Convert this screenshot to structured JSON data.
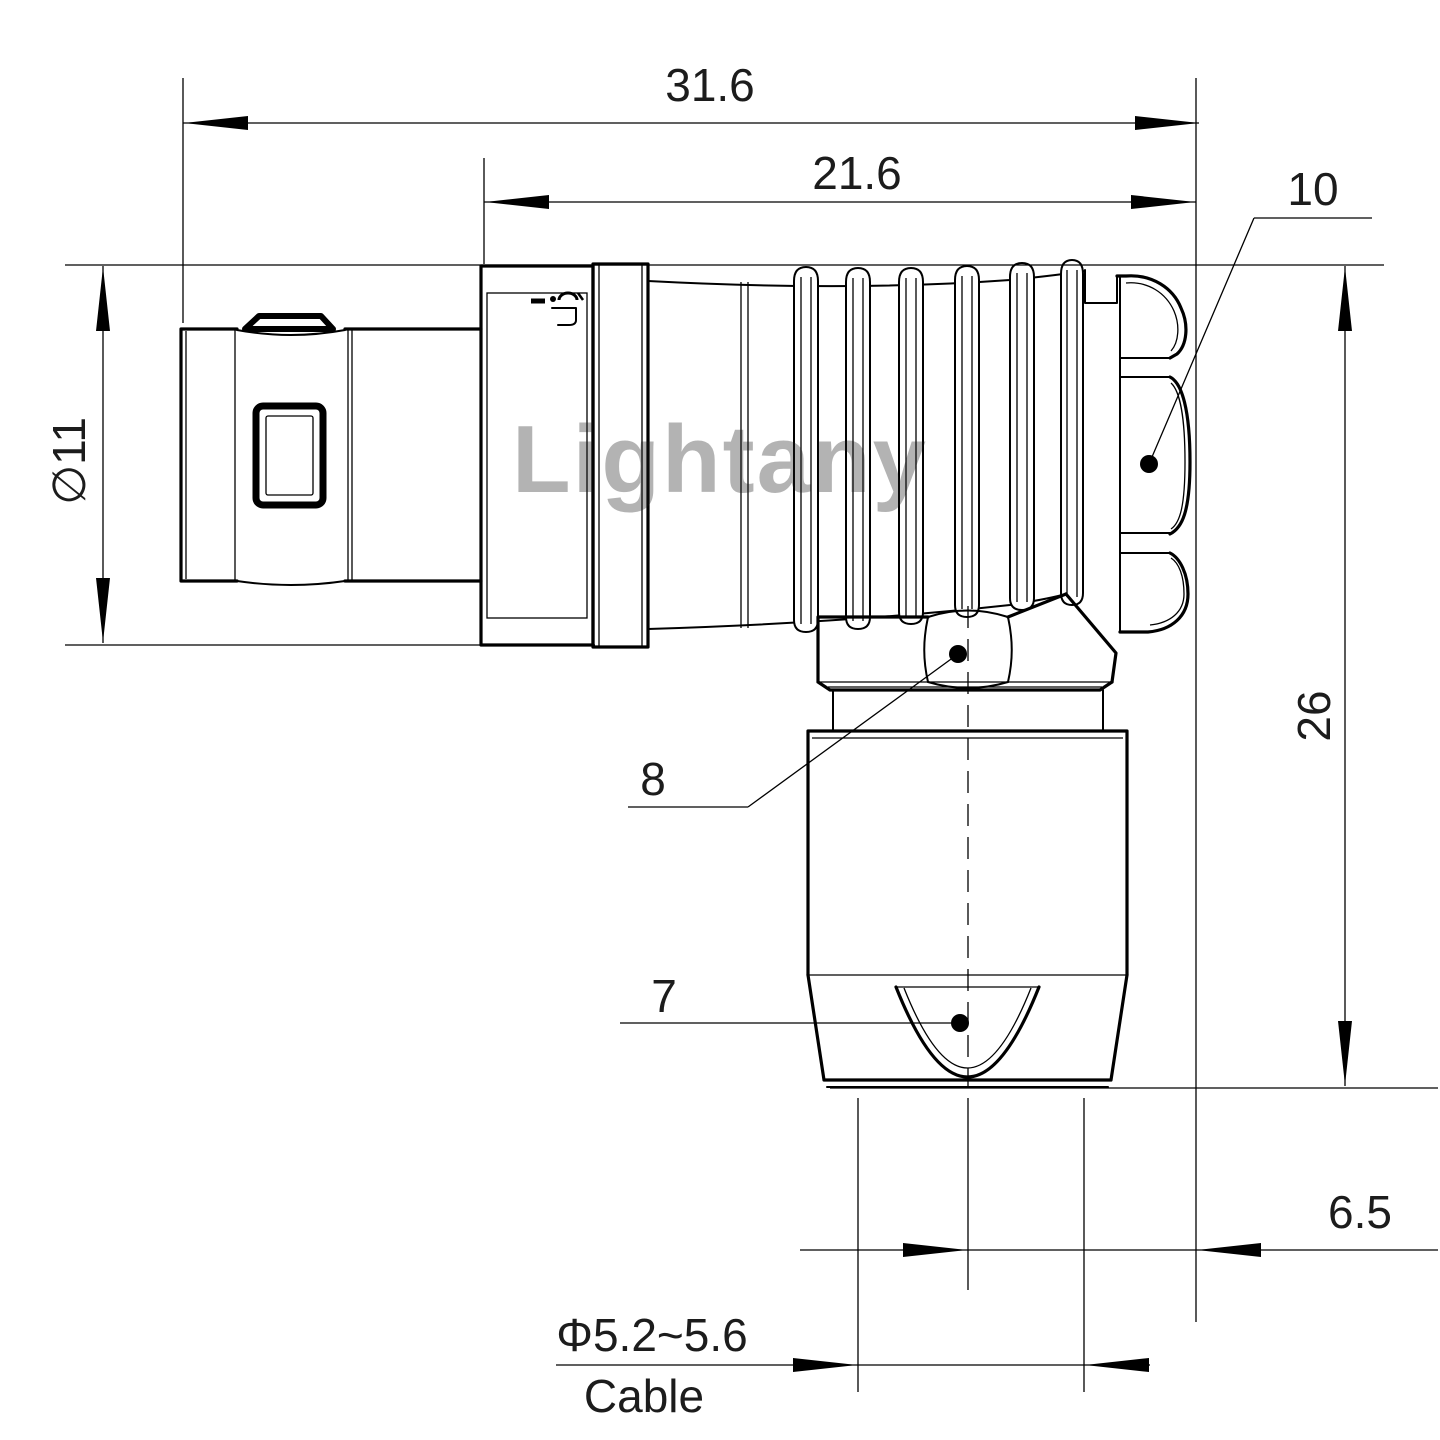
{
  "watermark": {
    "text": "Lightany",
    "color": "#e06e6e"
  },
  "dimensions": {
    "total_length": "31.6",
    "body_length": "21.6",
    "plug_diameter": "∅11",
    "height": "26",
    "elbow_offset": "6.5",
    "cable_diameter": "Φ5.2~5.6",
    "cable_label": "Cable"
  },
  "part_labels": {
    "coupling_nut": "10",
    "hex_nut": "8",
    "cable_bushing": "7"
  },
  "colors": {
    "line": "#000000",
    "background": "#ffffff"
  }
}
